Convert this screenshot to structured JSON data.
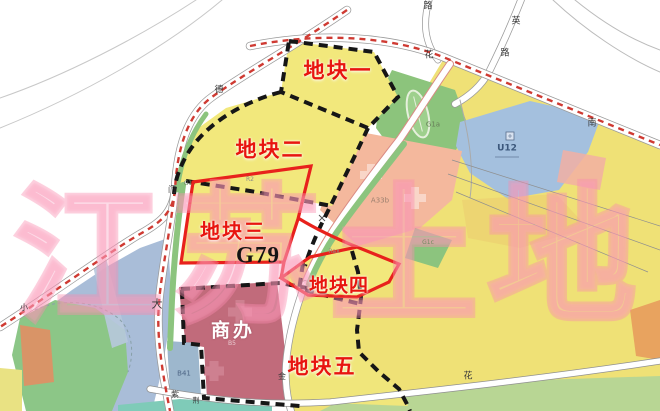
{
  "watermark": {
    "text": "江苏土地"
  },
  "plots": {
    "plot1": "地块一",
    "plot2": "地块二",
    "plot3": "地块三",
    "plot3_code": "G79",
    "plot4": "地块四",
    "plot5": "地块五",
    "commercial": "商办",
    "commercial_code": "B5"
  },
  "zone_codes": {
    "r2": "R2",
    "g1": "G1",
    "g1a": "G1a",
    "u12": "U12",
    "a33b": "A33b",
    "rax": "Rax",
    "g1c": "G1c",
    "b41": "B41"
  },
  "road_labels": {
    "lu_top": "路",
    "ying": "英",
    "lu_mid": "路",
    "hua_main": "花",
    "nan": "南",
    "de": "德",
    "men": "门",
    "da": "大",
    "xiao": "小",
    "jin": "金",
    "zi": "紫",
    "jing": "荆",
    "hua_south": "花"
  },
  "colors": {
    "plot_fill": "#f2e87c",
    "plot_outline_red": "#e8211c",
    "boundary_black": "#161616",
    "commercial_fill": "#c16b7b",
    "green_area": "#8cc47c",
    "blue_u12": "#a4c0de",
    "salmon_a33b": "#f4b89d",
    "water_blue": "#a9bdd8",
    "watermark_pink": "#fa8cb0",
    "label_red": "#e8150f"
  }
}
